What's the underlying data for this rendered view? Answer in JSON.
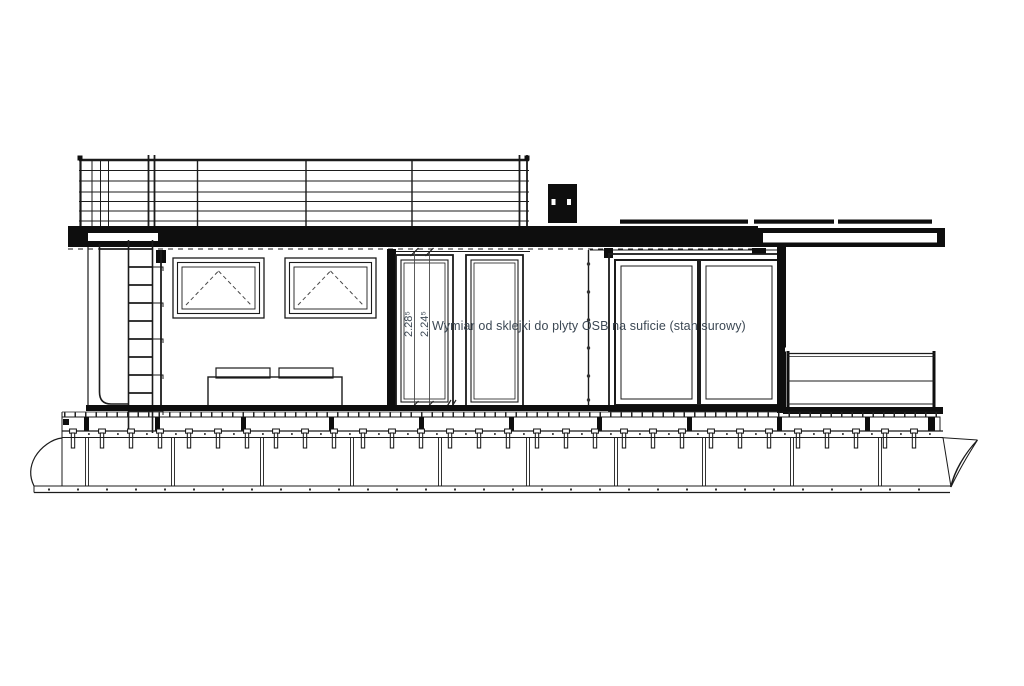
{
  "drawing": {
    "annotation": {
      "text": "Wymiar od sklejki do plyty OSB na suficie (stan surowy)",
      "color": "#3c4854"
    },
    "dimensions": [
      {
        "value": "2.28⁵"
      },
      {
        "value": "2.24⁵"
      }
    ],
    "colors": {
      "line": "#1b1b1b",
      "background": "#ffffff",
      "text": "#3c4854"
    }
  }
}
